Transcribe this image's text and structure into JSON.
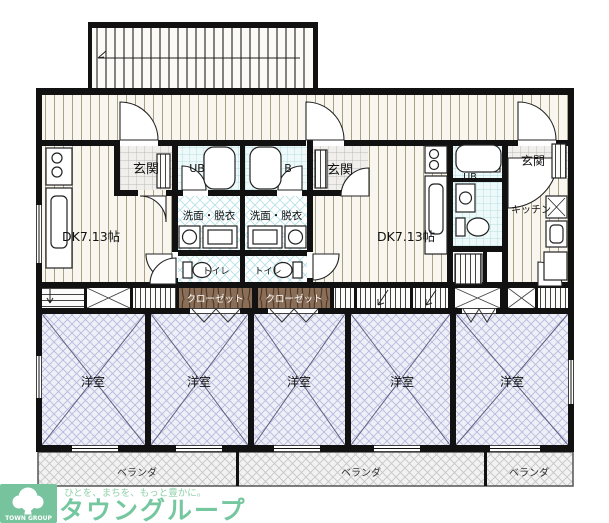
{
  "floor_plan": {
    "units": {
      "left": {
        "entrance": "玄関",
        "bath": "UB",
        "washroom": "洗面・脱衣",
        "toilet": "トイレ",
        "dk": "DK7.13帖",
        "closet": "クローゼット"
      },
      "middle": {
        "entrance": "玄関",
        "bath": "B",
        "washroom": "洗面・脱衣",
        "toilet": "トイレ",
        "dk": "DK7.13帖",
        "closet": "クローゼット"
      },
      "right": {
        "entrance": "玄関",
        "bath": "UB",
        "kitchen": "キッチン"
      }
    },
    "western_rooms": [
      "洋室",
      "洋室",
      "洋室",
      "洋室",
      "洋室"
    ],
    "verandas": [
      "ベランダ",
      "ベランダ",
      "ベランダ"
    ]
  },
  "branding": {
    "logo_caption": "TOWN GROUP",
    "tagline": "ひとを、まちを、もっと豊かに。",
    "brand_name": "タウングループ",
    "colors": {
      "logo_bg": "#76c39e",
      "brand_text": "#74c79f",
      "tagline_text": "#8fd0ab"
    }
  }
}
